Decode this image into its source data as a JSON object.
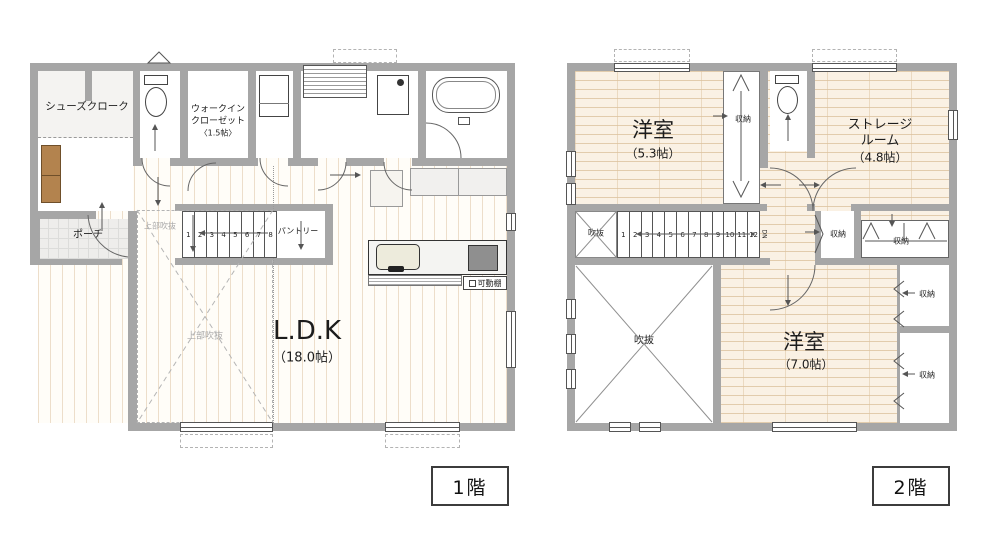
{
  "colors": {
    "wall": "#a6a6a6",
    "line": "#555555",
    "wood_floor": "#faf1e4",
    "stripe_floor": "#fffdf8",
    "accent_brown": "#b3834e",
    "stove_gray": "#8f8f8f"
  },
  "floor1": {
    "badge": "1階",
    "labels": {
      "shoes_cloak": "シューズクローク",
      "wic_line1": "ウォークイン",
      "wic_line2": "クローゼット",
      "wic_size": "〈1.5帖〉",
      "porch": "ポーチ",
      "void_small": "上部吹抜",
      "void_large": "上部吹抜",
      "pantry": "パントリー",
      "ldk": "L.D.K",
      "ldk_size": "（18.0帖）",
      "movable_shelf": "可動棚"
    },
    "stairs": [
      "1",
      "2",
      "3",
      "4",
      "5",
      "6",
      "7",
      "8"
    ]
  },
  "floor2": {
    "badge": "2階",
    "labels": {
      "bedroom1": "洋室",
      "bedroom1_size": "（5.3帖）",
      "storage_line1": "ストレージ",
      "storage_line2": "ルーム",
      "storage_size": "（4.8帖）",
      "bedroom2": "洋室",
      "bedroom2_size": "（7.0帖）",
      "void_small": "吹抜",
      "void_large": "吹抜",
      "closet_a": "収納",
      "closet_b": "収納",
      "closet_c": "収納",
      "closet_d": "収納",
      "closet_e": "収納",
      "dn": "DN"
    },
    "stairs": [
      "1",
      "2",
      "3",
      "4",
      "5",
      "6",
      "7",
      "8",
      "9",
      "10",
      "11",
      "12"
    ]
  }
}
